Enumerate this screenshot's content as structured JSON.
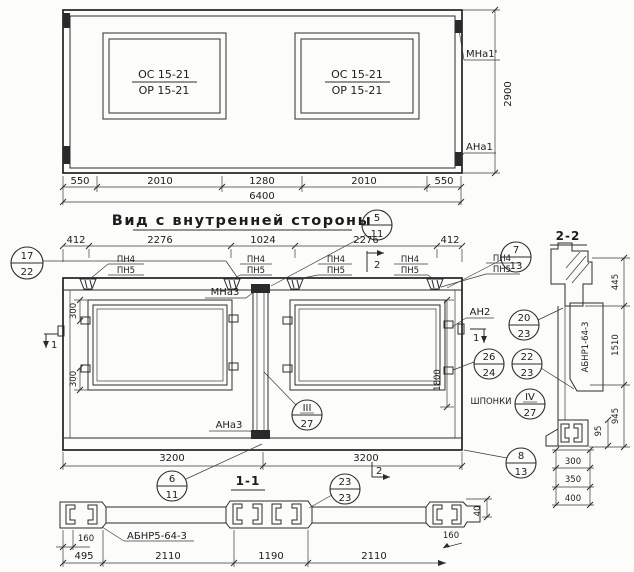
{
  "drawing": {
    "title_main": "Вид с внутренней стороны",
    "top_view": {
      "window_label_top": "ОС 15-21",
      "window_label_bottom": "ОР 15-21",
      "mark_top_right": "МНа1'",
      "mark_bottom_right": "АНа1",
      "dim_height": "2900",
      "dims_row": [
        "550",
        "2010",
        "1280",
        "2010",
        "550"
      ],
      "dim_total": "6400"
    },
    "mid_view": {
      "dims_row": [
        "412",
        "2276",
        "1024",
        "2276",
        "412"
      ],
      "pn_label_top": "ПН4",
      "pn_label_bottom": "ПН5",
      "mark_center_top": "МНа3",
      "mark_center_bottom": "АНа3",
      "mark_anchor_right": "АН2",
      "dim_anchor_top": "300",
      "dim_anchor_bottom": "300",
      "dim_window_height": "1800",
      "shponki_label": "ШПОНКИ",
      "dims_3200": [
        "3200",
        "3200"
      ],
      "section_marker_1": "1",
      "section_marker_2": "2"
    },
    "bottom_view": {
      "label": "1-1",
      "product_label": "АБНР5-64-3",
      "dim_160_left": "160",
      "dim_160_right": "160",
      "dim_40": "40",
      "dims_row": [
        "495",
        "2110",
        "1190",
        "2110"
      ]
    },
    "section_2_2": {
      "label": "2-2",
      "product_label": "АБНР1-64-3",
      "dim_445": "445",
      "dim_1510": "1510",
      "dim_945": "945",
      "dim_95": "95",
      "dims_stack": [
        "300",
        "350",
        "400"
      ]
    },
    "callouts": [
      {
        "top": "17",
        "bottom": "22"
      },
      {
        "top": "5",
        "bottom": "11"
      },
      {
        "top": "7",
        "bottom": "13"
      },
      {
        "top": "20",
        "bottom": "23"
      },
      {
        "top": "26",
        "bottom": "24"
      },
      {
        "top": "22",
        "bottom": "23"
      },
      {
        "top": "IV",
        "bottom": "27"
      },
      {
        "top": "III",
        "bottom": "27"
      },
      {
        "top": "6",
        "bottom": "11"
      },
      {
        "top": "8",
        "bottom": "13"
      },
      {
        "top": "23",
        "bottom": "23"
      }
    ]
  }
}
